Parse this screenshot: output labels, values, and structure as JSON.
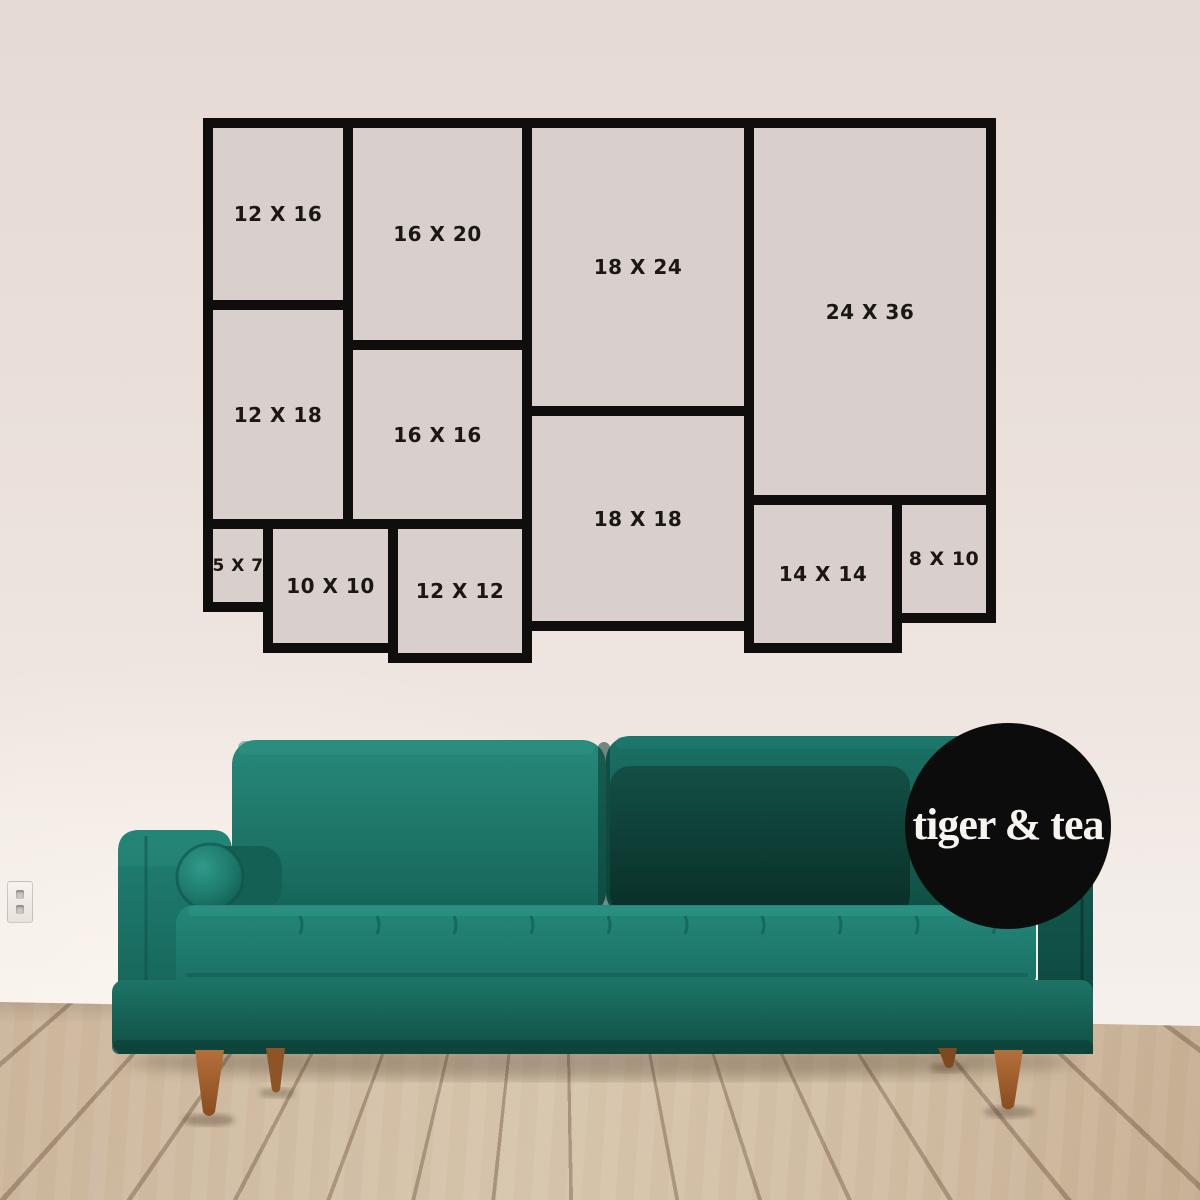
{
  "chart": {
    "items": [
      {
        "label": "12 X 16",
        "x": 203,
        "y": 118,
        "w": 150,
        "h": 192
      },
      {
        "label": "16 X 20",
        "x": 343,
        "y": 118,
        "w": 189,
        "h": 232
      },
      {
        "label": "18 X 24",
        "x": 522,
        "y": 118,
        "w": 232,
        "h": 298
      },
      {
        "label": "24 X 36",
        "x": 744,
        "y": 118,
        "w": 252,
        "h": 387
      },
      {
        "label": "12 X 18",
        "x": 203,
        "y": 300,
        "w": 150,
        "h": 229
      },
      {
        "label": "16 X 16",
        "x": 343,
        "y": 340,
        "w": 189,
        "h": 189
      },
      {
        "label": "18 X 18",
        "x": 522,
        "y": 406,
        "w": 232,
        "h": 225
      },
      {
        "label": "5 X 7",
        "x": 203,
        "y": 519,
        "w": 70,
        "h": 93,
        "fs": 17
      },
      {
        "label": "10 X 10",
        "x": 263,
        "y": 519,
        "w": 135,
        "h": 134
      },
      {
        "label": "12 X 12",
        "x": 388,
        "y": 519,
        "w": 144,
        "h": 144
      },
      {
        "label": "14 X 14",
        "x": 744,
        "y": 495,
        "w": 158,
        "h": 158
      },
      {
        "label": "8 X 10",
        "x": 892,
        "y": 495,
        "w": 104,
        "h": 128,
        "fs": 19
      }
    ]
  },
  "logo": {
    "text": "tiger & tea"
  },
  "colors": {
    "chart-line": "#0f0e0c",
    "chart-fill": "#d9cfcc",
    "label-color": "#1b1713",
    "logo-bg": "#0d0c0c",
    "logo-text": "#f7f4f0",
    "sofa-green": "#1f8071",
    "sofa-green-dark": "#0c4038",
    "floor-wood": "#d0bba1",
    "wall": "#ebe0dc",
    "leg-wood": "#a2602d"
  }
}
